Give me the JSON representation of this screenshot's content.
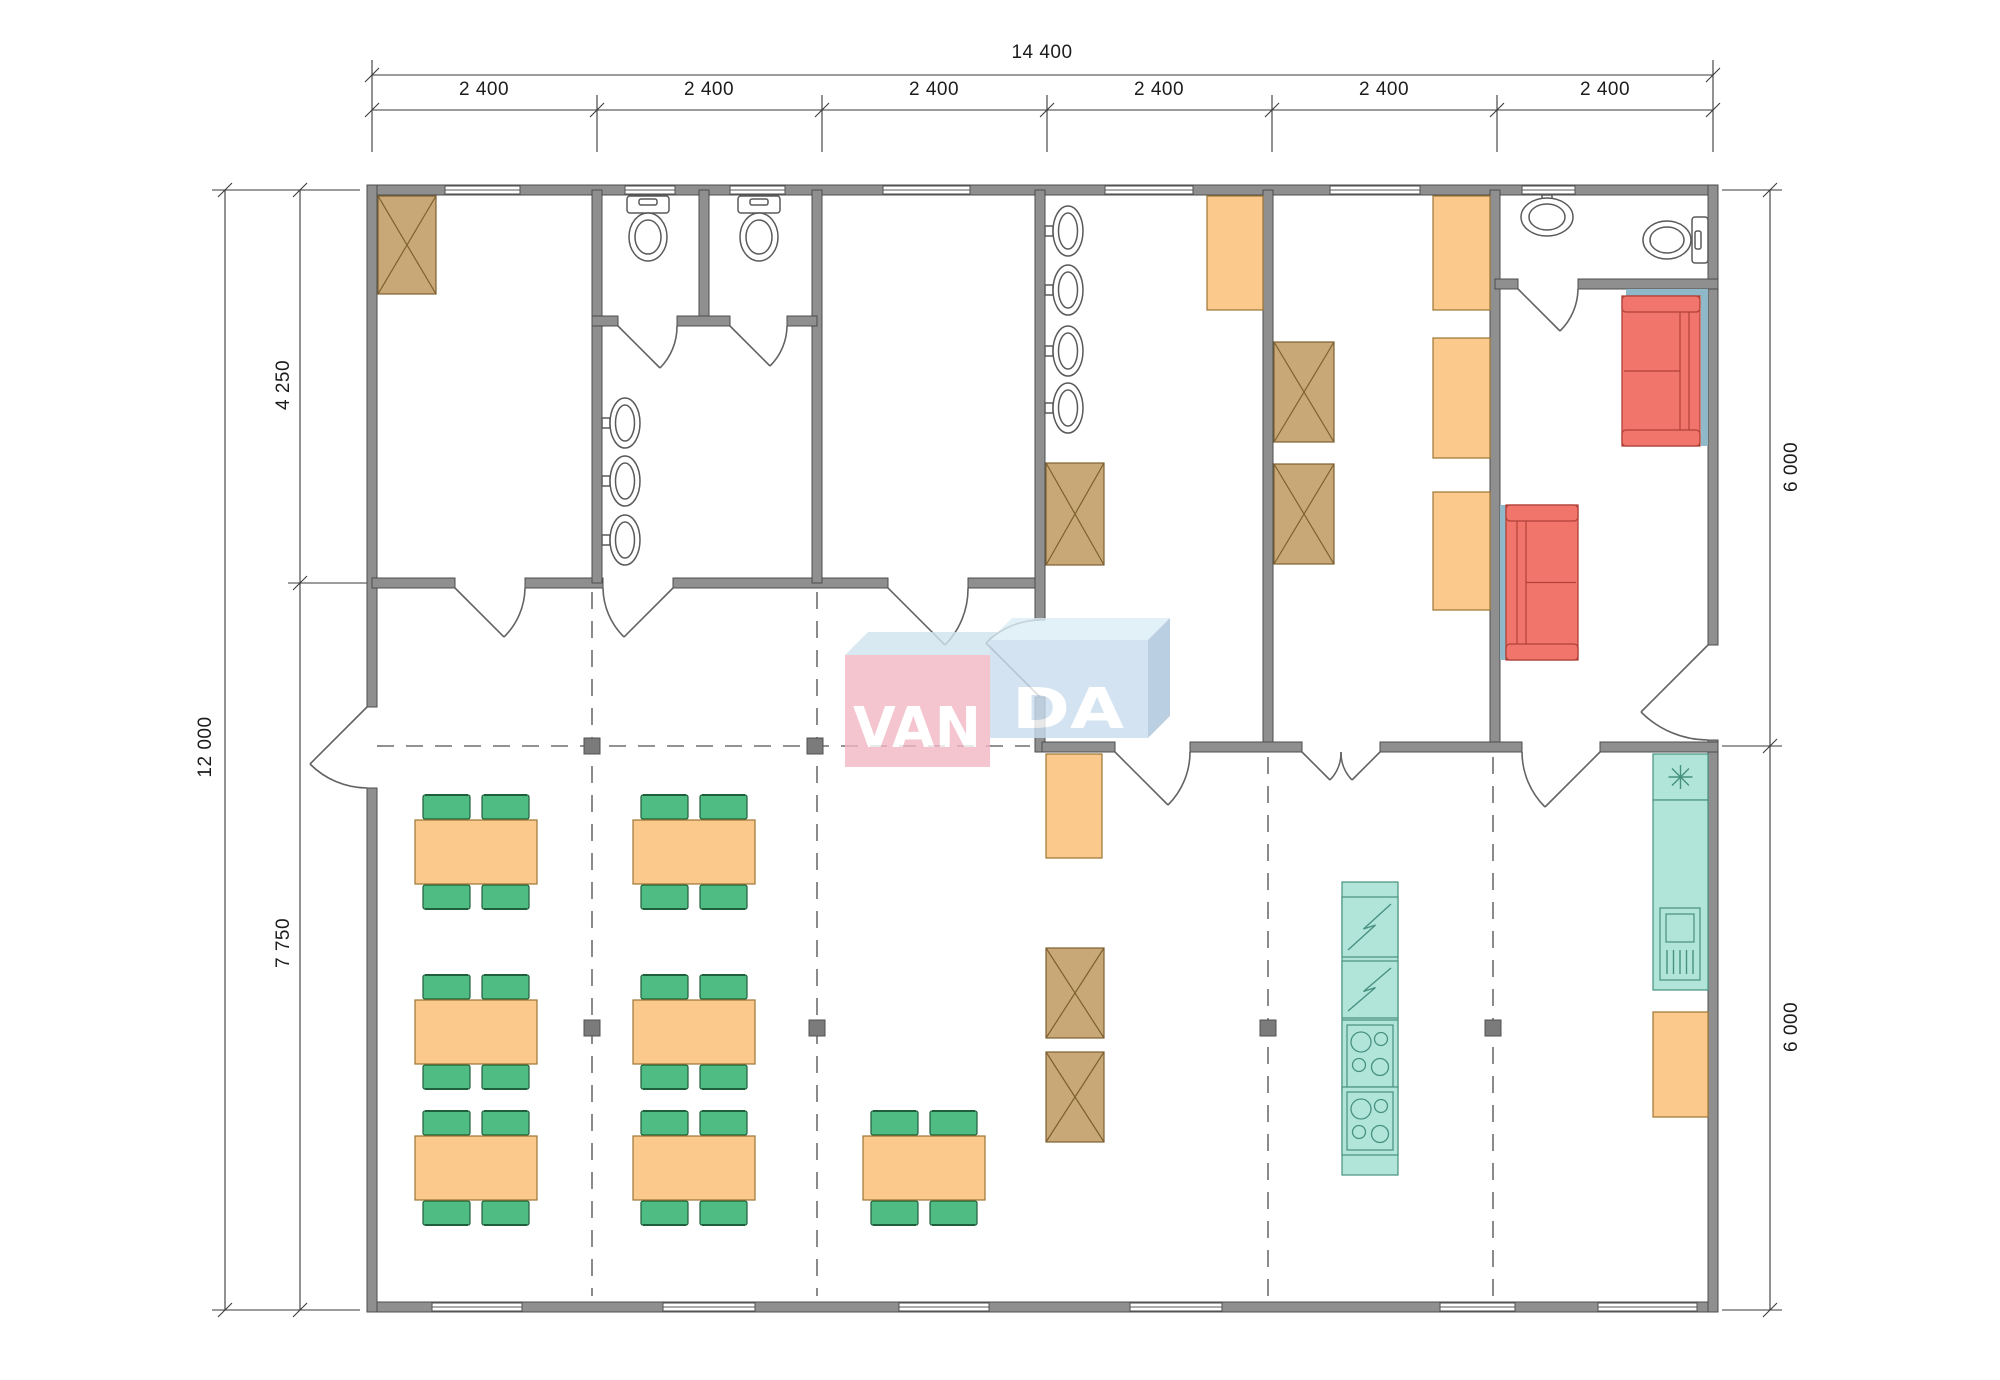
{
  "dimensions": {
    "top_total": "14 400",
    "top_segments": [
      "2 400",
      "2 400",
      "2 400",
      "2 400",
      "2 400",
      "2 400"
    ],
    "left_total": "12 000",
    "left_upper": "4 250",
    "left_lower": "7 750",
    "right_upper": "6 000",
    "right_lower": "6 000"
  },
  "logo": {
    "left": "VAN",
    "right": "DA"
  },
  "colors": {
    "wall": "#8f8f8f",
    "wall_edge": "#4c4c4c",
    "wardrobe": "#c9a878",
    "wardrobe_edge": "#7d6031",
    "furniture_orange": "#fbc98b",
    "furniture_orange_edge": "#9c7433",
    "chair_green": "#4fbc84",
    "chair_green_edge": "#1f5f3c",
    "sofa_red": "#f2756b",
    "sofa_red_edge": "#b04138",
    "appliance_teal": "#b2e5da",
    "appliance_teal_edge": "#47917f",
    "wall_pad_teal": "#8fb9c9",
    "dash_line": "#6e6e6e",
    "dimension_ink": "#1c1c1c",
    "fixture_stroke": "#5a5a5a",
    "logo_pink": "#f2b7c4",
    "logo_pink_top": "#cfe4f0",
    "logo_blue": "#c9ddee",
    "logo_blue_top": "#dcedf6",
    "logo_blue_side": "#a9c4da",
    "logo_text": "#ffffff"
  },
  "plan": {
    "items": [
      {
        "type": "wardrobe",
        "x": 378,
        "y": 196,
        "w": 58,
        "h": 98
      },
      {
        "type": "wardrobe",
        "x": 1046,
        "y": 463,
        "w": 58,
        "h": 102
      },
      {
        "type": "wardrobe",
        "x": 1274,
        "y": 342,
        "w": 60,
        "h": 100
      },
      {
        "type": "wardrobe",
        "x": 1274,
        "y": 464,
        "w": 60,
        "h": 100
      },
      {
        "type": "wardrobe",
        "x": 1046,
        "y": 948,
        "w": 58,
        "h": 90
      },
      {
        "type": "wardrobe",
        "x": 1046,
        "y": 1052,
        "w": 58,
        "h": 90
      },
      {
        "type": "storage-box",
        "x": 1207,
        "y": 196,
        "w": 56,
        "h": 114
      },
      {
        "type": "storage-box",
        "x": 1433,
        "y": 196,
        "w": 57,
        "h": 114
      },
      {
        "type": "storage-box",
        "x": 1433,
        "y": 338,
        "w": 57,
        "h": 120
      },
      {
        "type": "storage-box",
        "x": 1433,
        "y": 492,
        "w": 57,
        "h": 118
      },
      {
        "type": "storage-box",
        "x": 1046,
        "y": 754,
        "w": 56,
        "h": 104
      },
      {
        "type": "storage-box",
        "x": 1653,
        "y": 1012,
        "w": 55,
        "h": 105
      },
      {
        "type": "table",
        "x": 415,
        "y": 820,
        "w": 122,
        "h": 64
      },
      {
        "type": "table",
        "x": 633,
        "y": 820,
        "w": 122,
        "h": 64
      },
      {
        "type": "table",
        "x": 415,
        "y": 1000,
        "w": 122,
        "h": 64
      },
      {
        "type": "table",
        "x": 633,
        "y": 1000,
        "w": 122,
        "h": 64
      },
      {
        "type": "table",
        "x": 415,
        "y": 1136,
        "w": 122,
        "h": 64
      },
      {
        "type": "table",
        "x": 633,
        "y": 1136,
        "w": 122,
        "h": 64
      },
      {
        "type": "table",
        "x": 863,
        "y": 1136,
        "w": 122,
        "h": 64
      },
      {
        "type": "teal-strip",
        "x": 1626,
        "y": 289,
        "w": 82,
        "h": 7
      },
      {
        "type": "teal-strip",
        "x": 1701,
        "y": 296,
        "w": 7,
        "h": 150
      },
      {
        "type": "teal-strip",
        "x": 1500,
        "y": 505,
        "w": 6,
        "h": 155
      },
      {
        "type": "sofa",
        "x": 1622,
        "y": 296,
        "w": 78,
        "h": 150,
        "back": "right"
      },
      {
        "type": "sofa",
        "x": 1506,
        "y": 505,
        "w": 72,
        "h": 155,
        "back": "left"
      },
      {
        "type": "counter",
        "x": 1342,
        "y": 882,
        "w": 56,
        "h": 293
      },
      {
        "type": "dishwasher",
        "x": 1342,
        "y": 897,
        "w": 56,
        "h": 60
      },
      {
        "type": "dishwasher",
        "x": 1342,
        "y": 961,
        "w": 56,
        "h": 57
      },
      {
        "type": "stove",
        "x": 1347,
        "y": 1025,
        "w": 46,
        "h": 62
      },
      {
        "type": "stove",
        "x": 1347,
        "y": 1092,
        "w": 46,
        "h": 58
      },
      {
        "type": "fridge",
        "x": 1653,
        "y": 754,
        "w": 55,
        "h": 46
      },
      {
        "type": "counter",
        "x": 1653,
        "y": 800,
        "w": 55,
        "h": 190
      },
      {
        "type": "sink-unit",
        "x": 1660,
        "y": 908,
        "w": 40,
        "h": 72
      },
      {
        "type": "marker",
        "x": 592,
        "y": 746
      },
      {
        "type": "marker",
        "x": 815,
        "y": 746
      },
      {
        "type": "marker",
        "x": 592,
        "y": 1028
      },
      {
        "type": "marker",
        "x": 817,
        "y": 1028
      },
      {
        "type": "marker",
        "x": 1268,
        "y": 1028
      },
      {
        "type": "marker",
        "x": 1493,
        "y": 1028
      },
      {
        "type": "toilet",
        "x": 648,
        "y": 196,
        "dir": "down"
      },
      {
        "type": "toilet",
        "x": 759,
        "y": 196,
        "dir": "down"
      },
      {
        "type": "toilet",
        "x": 1692,
        "y": 240,
        "dir": "left"
      },
      {
        "type": "sink",
        "x": 602,
        "y": 423,
        "dir": "right"
      },
      {
        "type": "sink",
        "x": 602,
        "y": 481,
        "dir": "right"
      },
      {
        "type": "sink",
        "x": 602,
        "y": 540,
        "dir": "right"
      },
      {
        "type": "sink",
        "x": 1045,
        "y": 231,
        "dir": "right"
      },
      {
        "type": "sink",
        "x": 1045,
        "y": 290,
        "dir": "right"
      },
      {
        "type": "sink",
        "x": 1045,
        "y": 351,
        "dir": "right"
      },
      {
        "type": "sink",
        "x": 1045,
        "y": 408,
        "dir": "right"
      },
      {
        "type": "sink",
        "x": 1547,
        "y": 195,
        "dir": "down"
      }
    ]
  }
}
